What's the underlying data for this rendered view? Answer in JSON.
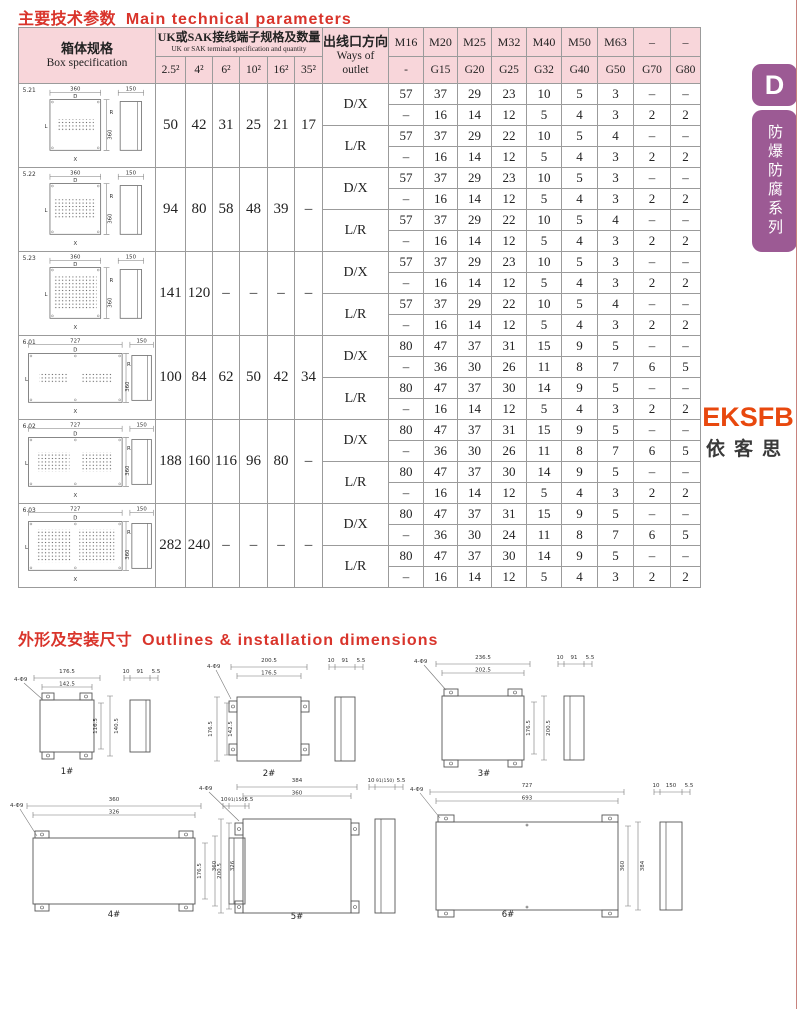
{
  "page": {
    "accent_red": "#d9342b",
    "header_pink": "#f8d6da",
    "sidebar_purple": "#9c5a94",
    "logo_orange": "#e8480e",
    "section1_title_zh": "主要技术参数",
    "section1_title_en": "Main technical parameters",
    "section2_title_zh": "外形及安装尺寸",
    "section2_title_en": "Outlines & installation dimensions"
  },
  "sidebar": {
    "tab_letter": "D",
    "series_label": "防爆防腐系列"
  },
  "logo": {
    "latin": "EKSFB",
    "cjk": "依客思"
  },
  "table": {
    "header": {
      "box_spec_zh": "箱体规格",
      "box_spec_en": "Box specification",
      "terminal_zh": "UK或SAK接线端子规格及数量",
      "terminal_en": "UK or SAK terminal specification and quantity",
      "terminal_sizes": [
        "2.5²",
        "4²",
        "6²",
        "10²",
        "16²",
        "35²"
      ],
      "ways_zh": "出线口方向",
      "ways_en": "Ways of outlet",
      "thread_row1": [
        "M16",
        "M20",
        "M25",
        "M32",
        "M40",
        "M50",
        "M63",
        "–",
        "–"
      ],
      "thread_row2": [
        "-",
        "G15",
        "G20",
        "G25",
        "G32",
        "G40",
        "G50",
        "G70",
        "G80"
      ]
    },
    "fig_labels": {
      "top": "D",
      "left": "L",
      "right": "R",
      "bottom": "X"
    },
    "groups": [
      {
        "code": "5.21",
        "fig": {
          "w": "360",
          "h": "360",
          "side": "150"
        },
        "terminals": [
          "50",
          "42",
          "31",
          "25",
          "21",
          "17"
        ],
        "rows": [
          {
            "way": "D/X",
            "v": [
              [
                "57",
                "37",
                "29",
                "23",
                "10",
                "5",
                "3",
                "–",
                "–"
              ],
              [
                "–",
                "16",
                "14",
                "12",
                "5",
                "4",
                "3",
                "2",
                "2"
              ]
            ]
          },
          {
            "way": "L/R",
            "v": [
              [
                "57",
                "37",
                "29",
                "22",
                "10",
                "5",
                "4",
                "–",
                "–"
              ],
              [
                "–",
                "16",
                "14",
                "12",
                "5",
                "4",
                "3",
                "2",
                "2"
              ]
            ]
          }
        ]
      },
      {
        "code": "5.22",
        "fig": {
          "w": "360",
          "h": "360",
          "side": "150"
        },
        "terminals": [
          "94",
          "80",
          "58",
          "48",
          "39",
          "–"
        ],
        "rows": [
          {
            "way": "D/X",
            "v": [
              [
                "57",
                "37",
                "29",
                "23",
                "10",
                "5",
                "3",
                "–",
                "–"
              ],
              [
                "–",
                "16",
                "14",
                "12",
                "5",
                "4",
                "3",
                "2",
                "2"
              ]
            ]
          },
          {
            "way": "L/R",
            "v": [
              [
                "57",
                "37",
                "29",
                "22",
                "10",
                "5",
                "4",
                "–",
                "–"
              ],
              [
                "–",
                "16",
                "14",
                "12",
                "5",
                "4",
                "3",
                "2",
                "2"
              ]
            ]
          }
        ]
      },
      {
        "code": "5.23",
        "fig": {
          "w": "360",
          "h": "360",
          "side": "150"
        },
        "terminals": [
          "141",
          "120",
          "–",
          "–",
          "–",
          "–"
        ],
        "rows": [
          {
            "way": "D/X",
            "v": [
              [
                "57",
                "37",
                "29",
                "23",
                "10",
                "5",
                "3",
                "–",
                "–"
              ],
              [
                "–",
                "16",
                "14",
                "12",
                "5",
                "4",
                "3",
                "2",
                "2"
              ]
            ]
          },
          {
            "way": "L/R",
            "v": [
              [
                "57",
                "37",
                "29",
                "22",
                "10",
                "5",
                "4",
                "–",
                "–"
              ],
              [
                "–",
                "16",
                "14",
                "12",
                "5",
                "4",
                "3",
                "2",
                "2"
              ]
            ]
          }
        ]
      },
      {
        "code": "6.01",
        "fig": {
          "w": "727",
          "h": "360",
          "side": "150"
        },
        "terminals": [
          "100",
          "84",
          "62",
          "50",
          "42",
          "34"
        ],
        "rows": [
          {
            "way": "D/X",
            "v": [
              [
                "80",
                "47",
                "37",
                "31",
                "15",
                "9",
                "5",
                "–",
                "–"
              ],
              [
                "–",
                "36",
                "30",
                "26",
                "11",
                "8",
                "7",
                "6",
                "5"
              ]
            ]
          },
          {
            "way": "L/R",
            "v": [
              [
                "80",
                "47",
                "37",
                "30",
                "14",
                "9",
                "5",
                "–",
                "–"
              ],
              [
                "–",
                "16",
                "14",
                "12",
                "5",
                "4",
                "3",
                "2",
                "2"
              ]
            ]
          }
        ]
      },
      {
        "code": "6.02",
        "fig": {
          "w": "727",
          "h": "360",
          "side": "150"
        },
        "terminals": [
          "188",
          "160",
          "116",
          "96",
          "80",
          "–"
        ],
        "rows": [
          {
            "way": "D/X",
            "v": [
              [
                "80",
                "47",
                "37",
                "31",
                "15",
                "9",
                "5",
                "–",
                "–"
              ],
              [
                "–",
                "36",
                "30",
                "26",
                "11",
                "8",
                "7",
                "6",
                "5"
              ]
            ]
          },
          {
            "way": "L/R",
            "v": [
              [
                "80",
                "47",
                "37",
                "30",
                "14",
                "9",
                "5",
                "–",
                "–"
              ],
              [
                "–",
                "16",
                "14",
                "12",
                "5",
                "4",
                "3",
                "2",
                "2"
              ]
            ]
          }
        ]
      },
      {
        "code": "6.03",
        "fig": {
          "w": "727",
          "h": "360",
          "side": "150"
        },
        "terminals": [
          "282",
          "240",
          "–",
          "–",
          "–",
          "–"
        ],
        "rows": [
          {
            "way": "D/X",
            "v": [
              [
                "80",
                "47",
                "37",
                "31",
                "15",
                "9",
                "5",
                "–",
                "–"
              ],
              [
                "–",
                "36",
                "30",
                "24",
                "11",
                "8",
                "7",
                "6",
                "5"
              ]
            ]
          },
          {
            "way": "L/R",
            "v": [
              [
                "80",
                "47",
                "37",
                "30",
                "14",
                "9",
                "5",
                "–",
                "–"
              ],
              [
                "–",
                "16",
                "14",
                "12",
                "5",
                "4",
                "3",
                "2",
                "2"
              ]
            ]
          }
        ]
      }
    ]
  },
  "outlines": {
    "drawings": [
      {
        "label": "1#",
        "holes": "4-Φ9",
        "top_outer": "176.5",
        "top_inner": "142.5",
        "v_outer": "140.5",
        "v_inner": "116.5",
        "side": [
          "10",
          "91",
          "5.5"
        ]
      },
      {
        "label": "2#",
        "holes": "4-Φ9",
        "top_outer": "200.5",
        "top_inner": "176.5",
        "v_outer": "176.5",
        "v_inner": "142.5",
        "side": [
          "10",
          "91",
          "5.5"
        ]
      },
      {
        "label": "3#",
        "holes": "4-Φ9",
        "top_outer": "236.5",
        "top_inner": "202.5",
        "v_outer": "200.5",
        "v_inner": "176.5",
        "side": [
          "10",
          "91",
          "5.5"
        ]
      },
      {
        "label": "4#",
        "holes": "4-Φ9",
        "top_outer": "360",
        "top_inner": "326",
        "v_outer": "200.5",
        "v_inner": "176.5",
        "side": [
          "10",
          "91(150)",
          "5.5"
        ]
      },
      {
        "label": "5#",
        "holes": "4-Φ9",
        "top_outer": "384",
        "top_inner": "360",
        "v_outer": "360",
        "v_inner": "326",
        "side": [
          "10",
          "91(150)",
          "5.5"
        ]
      },
      {
        "label": "6#",
        "holes": "4-Φ9",
        "top_outer": "727",
        "top_inner": "693",
        "v_outer": "384",
        "v_inner": "360",
        "side": [
          "10",
          "150",
          "5.5"
        ]
      }
    ]
  }
}
